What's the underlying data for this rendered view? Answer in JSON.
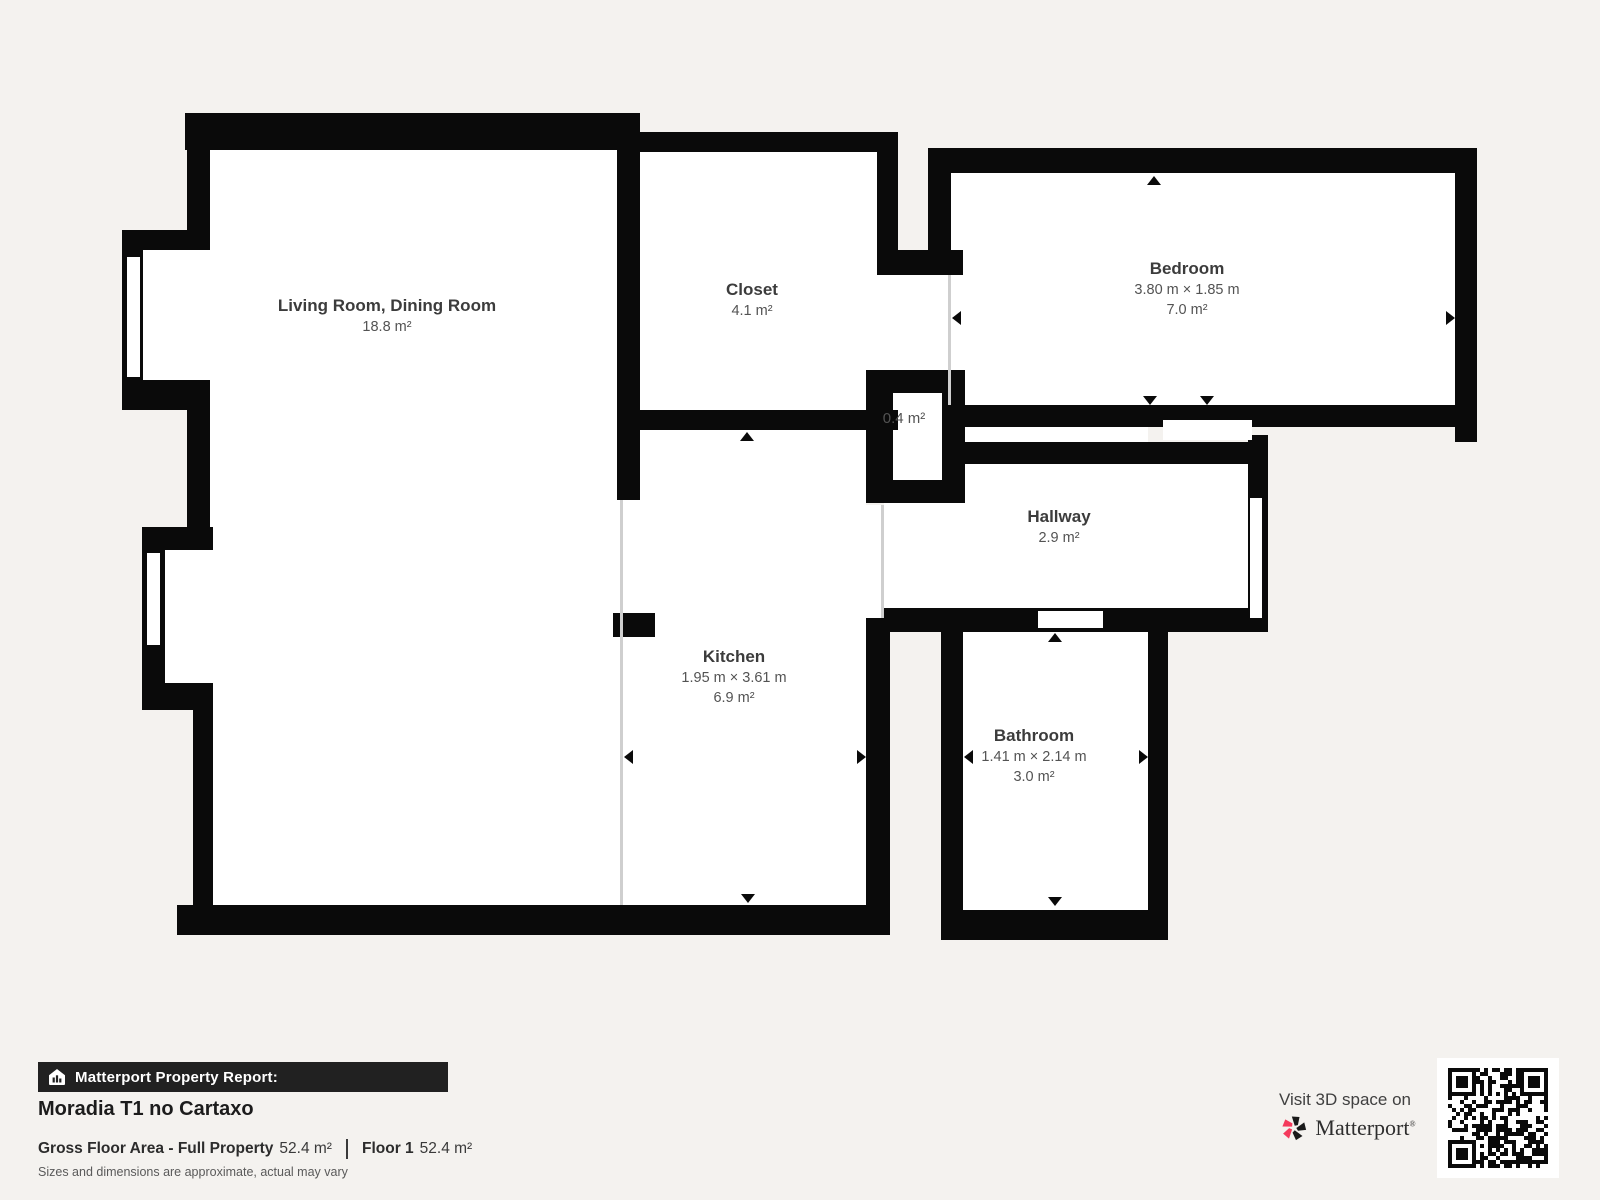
{
  "plan": {
    "rooms": {
      "living": {
        "name": "Living Room, Dining Room",
        "dims": "",
        "area": "18.8 m²"
      },
      "closet": {
        "name": "Closet",
        "dims": "",
        "area": "4.1 m²"
      },
      "bedroom": {
        "name": "Bedroom",
        "dims": "3.80 m × 1.85 m",
        "area": "7.0 m²"
      },
      "storage": {
        "name": "",
        "dims": "",
        "area": "0.4 m²"
      },
      "hallway": {
        "name": "Hallway",
        "dims": "",
        "area": "2.9 m²"
      },
      "kitchen": {
        "name": "Kitchen",
        "dims": "1.95 m × 3.61 m",
        "area": "6.9 m²"
      },
      "bathroom": {
        "name": "Bathroom",
        "dims": "1.41 m × 2.14 m",
        "area": "3.0 m²"
      }
    },
    "colors": {
      "wall": "#0a0a0a",
      "floor": "#ffffff",
      "outside": "#f4f2ef",
      "open_boundary": "#cfcfcf"
    }
  },
  "footer": {
    "report_label": "Matterport Property Report:",
    "title": "Moradia T1 no Cartaxo",
    "stats": [
      {
        "label": "Gross Floor Area - Full Property",
        "value": "52.4 m²"
      },
      {
        "label": "Floor 1",
        "value": "52.4 m²"
      }
    ],
    "disclaimer": "Sizes and dimensions are approximate, actual may vary"
  },
  "promo": {
    "visit": "Visit 3D space on",
    "brand": "Matterport",
    "brand_accent": "#f43a5c",
    "icons": [
      "house-chart-icon",
      "matterport-pinwheel-icon",
      "qr-code"
    ]
  }
}
